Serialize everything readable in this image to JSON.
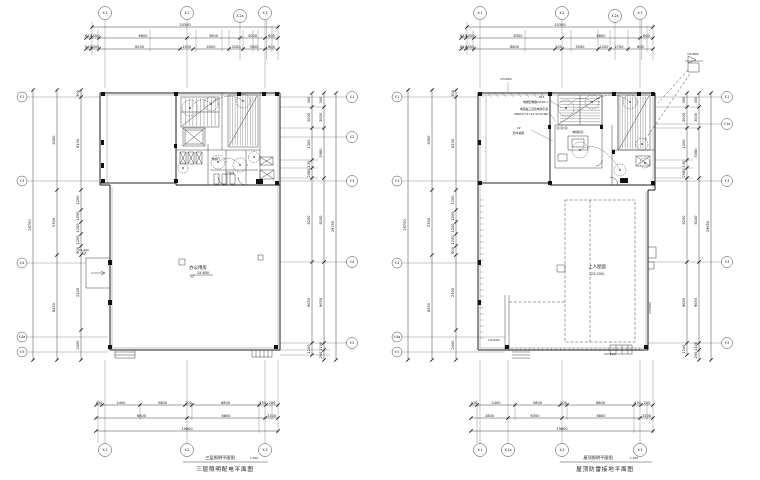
{
  "drawing": {
    "left": {
      "grid_top": [
        "X-1",
        "X-2",
        "X-2a",
        "X-3"
      ],
      "grid_bottom": [
        "X-1",
        "X-2",
        "X-3"
      ],
      "grid_left": [
        "Y-1",
        "Y-3",
        "Y-4",
        "Y-4a",
        "Y-5"
      ],
      "grid_right": [
        "Y-1",
        "Y-2",
        "Y-3",
        "Y-4",
        "Y-5"
      ],
      "dim_top_total": [
        "20300"
      ],
      "dim_top_row2": [
        "640",
        "1500",
        "6800",
        "5800",
        "3000",
        "600"
      ],
      "dim_top_row3": [
        "640",
        "1500",
        "6200",
        "1300",
        "4500",
        "3200",
        "3000",
        "600"
      ],
      "dim_bottom_row1": [
        "430",
        "2400",
        "5800",
        "200",
        "6800",
        "530",
        "200"
      ],
      "dim_bottom_row2": [
        "6800",
        "6800",
        "3200"
      ],
      "dim_bottom_total": [
        "19800"
      ],
      "dim_left_total": [
        "29750"
      ],
      "dim_left_chain1": [
        "8300",
        "5300",
        "8450"
      ],
      "dim_left_chain2": [
        "300",
        "8100",
        "1200",
        "1500",
        "1200",
        "1200",
        "900",
        "2100",
        "2400"
      ],
      "dim_right_chain1": [
        "300",
        "3000",
        "1300",
        "130",
        "2080",
        "8200",
        "9050",
        "1100"
      ],
      "dim_right_chain2": [
        "300",
        "3000",
        "5080",
        "8100",
        "9050",
        "1100",
        "200"
      ],
      "dim_right_total": [
        "29750"
      ],
      "room_label": "办公用房",
      "room_elevation": "15.600",
      "bay_elevation": "11.000",
      "core_labels": [
        "电梯厅",
        "卫生间"
      ],
      "title": "三层照明平面图",
      "title_scale": "1:100",
      "subtitle": "三层照明配电平面图"
    },
    "right": {
      "grid_top": [
        "X-1",
        "X-2",
        "X-2a",
        "X-3"
      ],
      "grid_bottom": [
        "X-1",
        "X-1a",
        "X-2",
        "X-3"
      ],
      "grid_left": [
        "Y-1",
        "Y-3",
        "Y-4",
        "Y-4a",
        "Y-5"
      ],
      "grid_right": [
        "Y-1",
        "Y-1a",
        "Y-3",
        "Y-4",
        "Y-5"
      ],
      "dim_top_total": [
        "20300"
      ],
      "dim_top_row2": [
        "640",
        "1500",
        "8300",
        "8800",
        "600"
      ],
      "dim_top_row3": [
        "640",
        "1500",
        "8600",
        "200",
        "5500",
        "1200",
        "2700",
        "600"
      ],
      "dim_bottom_row1": [
        "430",
        "2400",
        "5800",
        "200",
        "8800",
        "530",
        "200"
      ],
      "dim_bottom_row2": [
        "2800",
        "6300",
        "8800",
        "3200"
      ],
      "dim_bottom_total": [
        "19800"
      ],
      "dim_left_total": [
        "29750"
      ],
      "dim_left_chain1": [
        "8300",
        "5300",
        "8450"
      ],
      "dim_left_chain2": [
        "300",
        "8100",
        "1200",
        "1500",
        "1200",
        "1200",
        "900",
        "2100",
        "2400"
      ],
      "dim_right_chain1": [
        "300",
        "3000",
        "1300",
        "130",
        "2080",
        "8200",
        "9050",
        "1100"
      ],
      "dim_right_chain2": [
        "300",
        "3000",
        "5080",
        "8100",
        "9050",
        "1100",
        "200"
      ],
      "dim_right_total": [
        "29650"
      ],
      "room_label": "上人屋面",
      "room_elevation": "(23.200)",
      "elev_top_left": "(23.600)",
      "elev_flag": "(25.600)",
      "elev_bottom_left": "(23.950)",
      "elev_bottom_right": "(23.950)",
      "elev_right_edge": "(23.950)",
      "machine_room_label": "电梯机房",
      "ann1": [
        "AP1",
        "电梯配电箱AP-DT-1"
      ],
      "ann2": [
        "电源由三层强电井引来",
        "WDZ-YJY-4×10-SC32-WE"
      ],
      "ann3": [
        "1P",
        "防水插座"
      ],
      "title": "屋顶照明平面图",
      "title_scale": "1:100",
      "subtitle": "屋顶防雷接地平面图"
    }
  }
}
